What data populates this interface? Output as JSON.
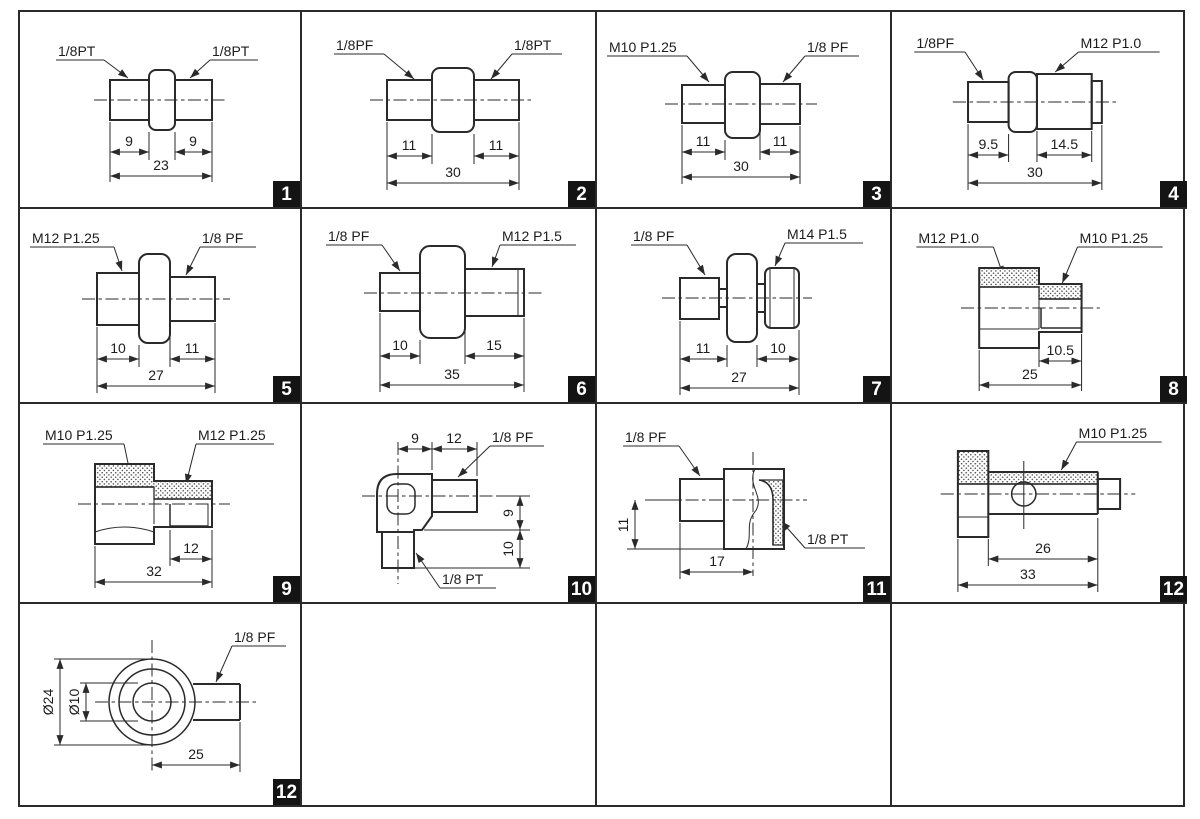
{
  "sheet": {
    "description": "Thread adapter fittings drawing sheet",
    "line_color": "#2a2a2a",
    "badge_bg": "#141414",
    "badge_fg": "#ffffff"
  },
  "cells": [
    {
      "badge": "1",
      "labels": [
        "1/8PT",
        "1/8PT"
      ],
      "dims": [
        "9",
        "9",
        "23"
      ]
    },
    {
      "badge": "2",
      "labels": [
        "1/8PF",
        "1/8PT"
      ],
      "dims": [
        "11",
        "11",
        "30"
      ]
    },
    {
      "badge": "3",
      "labels": [
        "M10 P1.25",
        "1/8 PF"
      ],
      "dims": [
        "11",
        "11",
        "30"
      ]
    },
    {
      "badge": "4",
      "labels": [
        "1/8PF",
        "M12 P1.0"
      ],
      "dims": [
        "9.5",
        "14.5",
        "30"
      ]
    },
    {
      "badge": "5",
      "labels": [
        "M12 P1.25",
        "1/8 PF"
      ],
      "dims": [
        "10",
        "11",
        "27"
      ]
    },
    {
      "badge": "6",
      "labels": [
        "1/8 PF",
        "M12 P1.5"
      ],
      "dims": [
        "10",
        "15",
        "35"
      ]
    },
    {
      "badge": "7",
      "labels": [
        "1/8 PF",
        "M14 P1.5"
      ],
      "dims": [
        "11",
        "10",
        "27"
      ]
    },
    {
      "badge": "8",
      "labels": [
        "M12 P1.0",
        "M10 P1.25"
      ],
      "dims": [
        "10.5",
        "25"
      ]
    },
    {
      "badge": "9",
      "labels": [
        "M10 P1.25",
        "M12 P1.25"
      ],
      "dims": [
        "12",
        "32"
      ]
    },
    {
      "badge": "10",
      "labels": [
        "1/8 PF",
        "1/8 PT"
      ],
      "dims": [
        "9",
        "12",
        "9",
        "10"
      ]
    },
    {
      "badge": "11",
      "labels": [
        "1/8 PF",
        "1/8 PT"
      ],
      "dims": [
        "11",
        "17"
      ]
    },
    {
      "badge": "12",
      "labels": [
        "M10 P1.25"
      ],
      "dims": [
        "26",
        "33"
      ]
    },
    {
      "badge": "12",
      "labels": [
        "1/8 PF"
      ],
      "dims": [
        "Ø24",
        "Ø10",
        "25"
      ]
    }
  ]
}
